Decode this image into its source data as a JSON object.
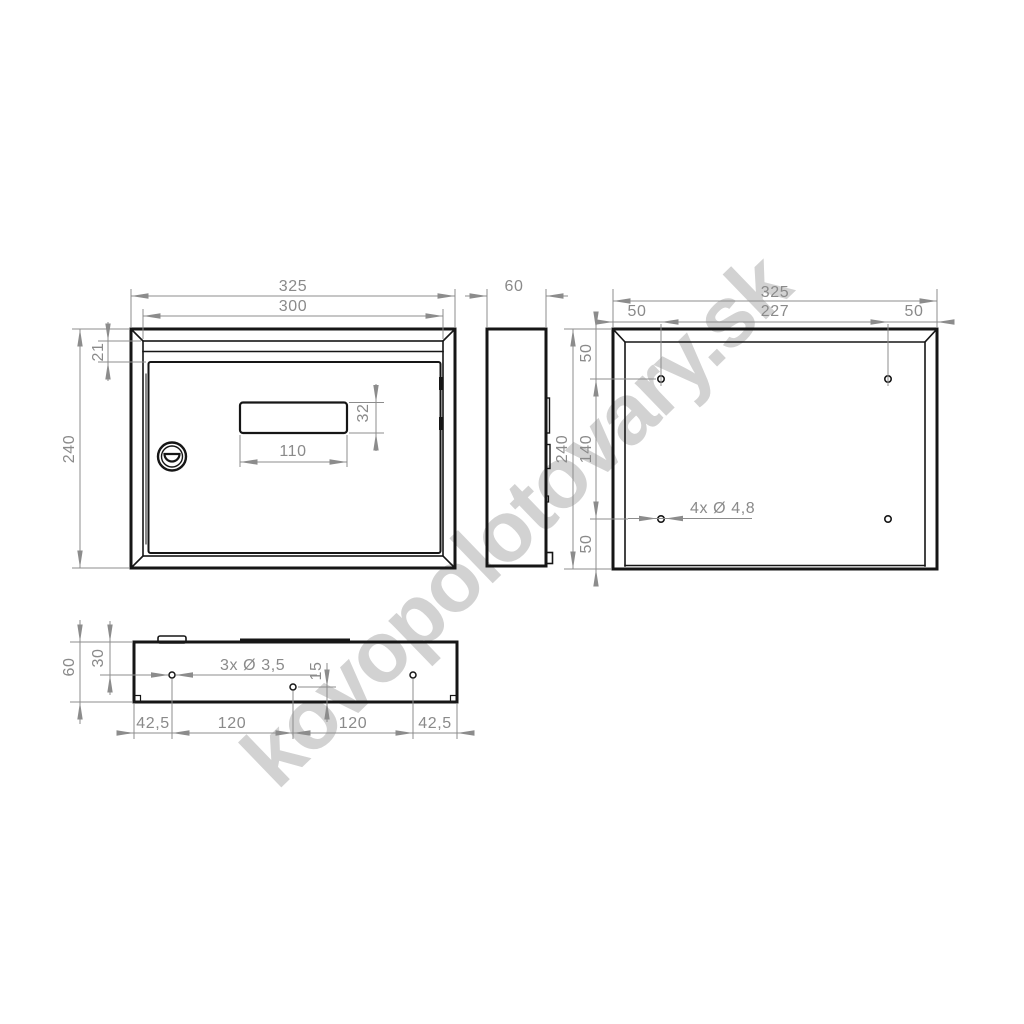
{
  "watermark": {
    "text": "kovopolotovary.sk",
    "color": "#d2d2d2"
  },
  "colors": {
    "object_line": "#161616",
    "dimension": "#8a8a8a",
    "background": "#ffffff"
  },
  "front_view": {
    "outer_width": "325",
    "inner_width": "300",
    "height": "240",
    "door_offset": "21",
    "slot_width": "110",
    "slot_height": "32"
  },
  "side_view": {
    "depth": "60"
  },
  "back_view": {
    "width": "325",
    "hole_margin_left": "50",
    "hole_spacing": "227",
    "hole_margin_right": "50",
    "height": "240",
    "hole_margin_top": "50",
    "hole_spacing_vertical": "140",
    "hole_margin_bottom": "50",
    "holes_note": "4x Ø 4,8"
  },
  "bottom_view": {
    "depth": "60",
    "hole_offset_top": "30",
    "hole_offset_bottom": "15",
    "holes_note": "3x Ø 3,5",
    "margin_left": "42,5",
    "spacing_1": "120",
    "spacing_2": "120",
    "margin_right": "42,5"
  }
}
